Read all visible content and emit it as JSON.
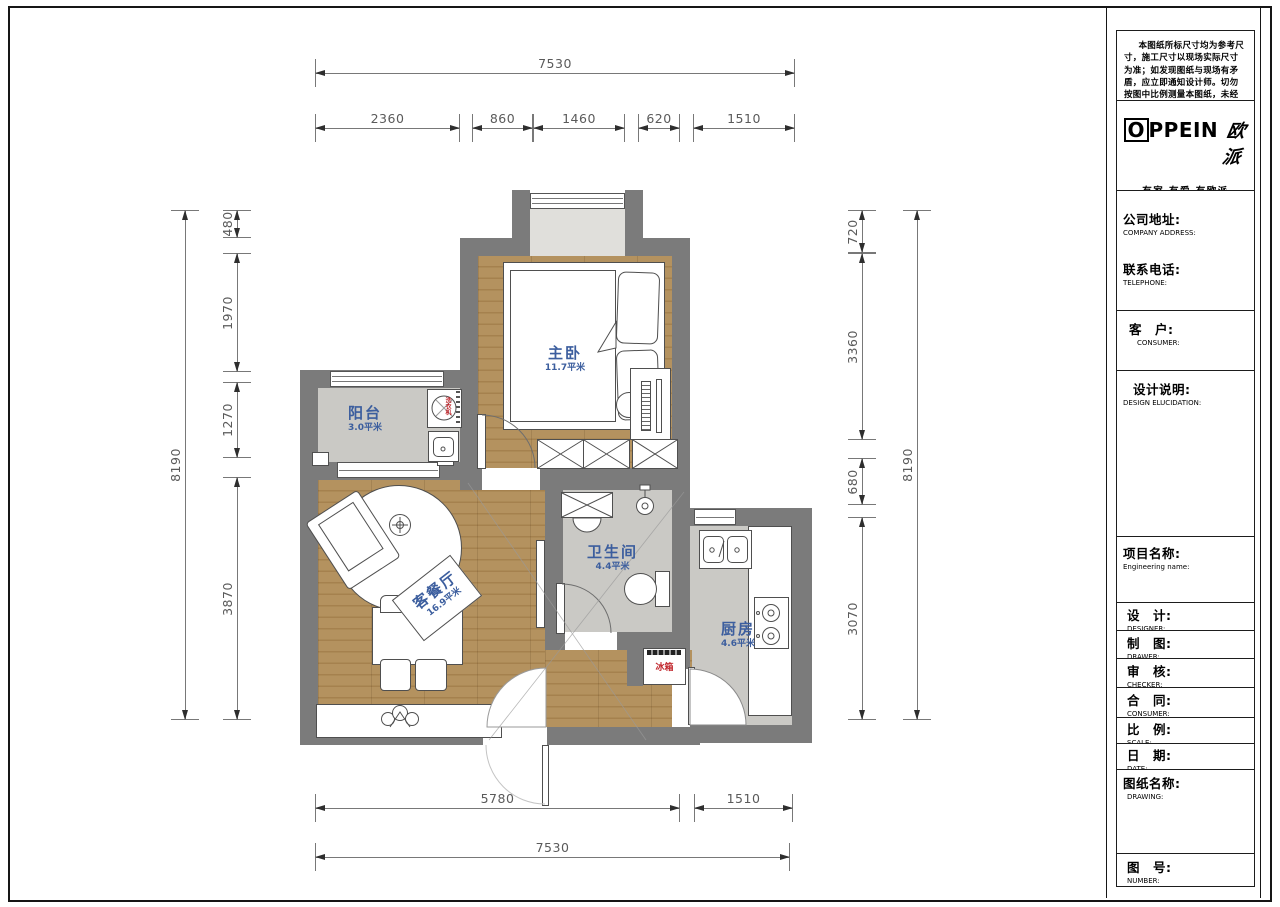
{
  "sheet": {
    "note": "本图纸所标尺寸均为参考尺寸，施工尺寸以现场实际尺寸为准；如发现图纸与现场有矛盾，应立即通知设计师。切勿按图中比例测量本图纸，未经允许翻印无效。",
    "logo": {
      "brand_first": "O",
      "brand_rest": "PPEIN",
      "brand_cn": "欧派",
      "slogan": "有家 有爱 有欧派"
    },
    "fields": [
      {
        "zh": "公司地址:",
        "en": "COMPANY ADDRESS:"
      },
      {
        "zh": "联系电话:",
        "en": "TELEPHONE:"
      },
      {
        "zh": "客　户:",
        "en": "CONSUMER:"
      },
      {
        "zh": "设计说明:",
        "en": "DESIGN ELUCIDATION:"
      },
      {
        "zh": "项目名称:",
        "en": "Engineering name:"
      },
      {
        "zh": "设　计:",
        "en": "DESIGNER:"
      },
      {
        "zh": "制　图:",
        "en": "DRAWER:"
      },
      {
        "zh": "审　核:",
        "en": "CHECKER:"
      },
      {
        "zh": "合　同:",
        "en": "CONSUMER:"
      },
      {
        "zh": "比　例:",
        "en": "SCALE:"
      },
      {
        "zh": "日　期:",
        "en": "DATE:"
      },
      {
        "zh": "图纸名称:",
        "en": "DRAWING:"
      },
      {
        "zh": "图　号:",
        "en": "NUMBER:"
      }
    ]
  },
  "rooms": {
    "bedroom": {
      "name": "主卧",
      "area": "11.7平米"
    },
    "balcony": {
      "name": "阳台",
      "area": "3.0平米"
    },
    "living": {
      "name": "客餐厅",
      "area": "16.9平米"
    },
    "bath": {
      "name": "卫生间",
      "area": "4.4平米"
    },
    "kitchen": {
      "name": "厨房",
      "area": "4.6平米"
    }
  },
  "labels": {
    "fridge": "冰箱",
    "washer": "洗衣机"
  },
  "dims": {
    "top_total": "7530",
    "top": [
      "2360",
      "860",
      "1460",
      "620",
      "1510"
    ],
    "bottom": [
      "5780",
      "1510"
    ],
    "bottom_total": "7530",
    "left_total": "8190",
    "left": [
      "480",
      "1970",
      "1270",
      "3870"
    ],
    "right": [
      "720",
      "3360",
      "680",
      "3070"
    ],
    "right_total": "8190"
  },
  "colors": {
    "wall": "#7b7b7b",
    "wood": "#b4925f",
    "tile": "#cac9c5",
    "room_label": "#3c5e9e",
    "warn_red": "#c1272d"
  }
}
